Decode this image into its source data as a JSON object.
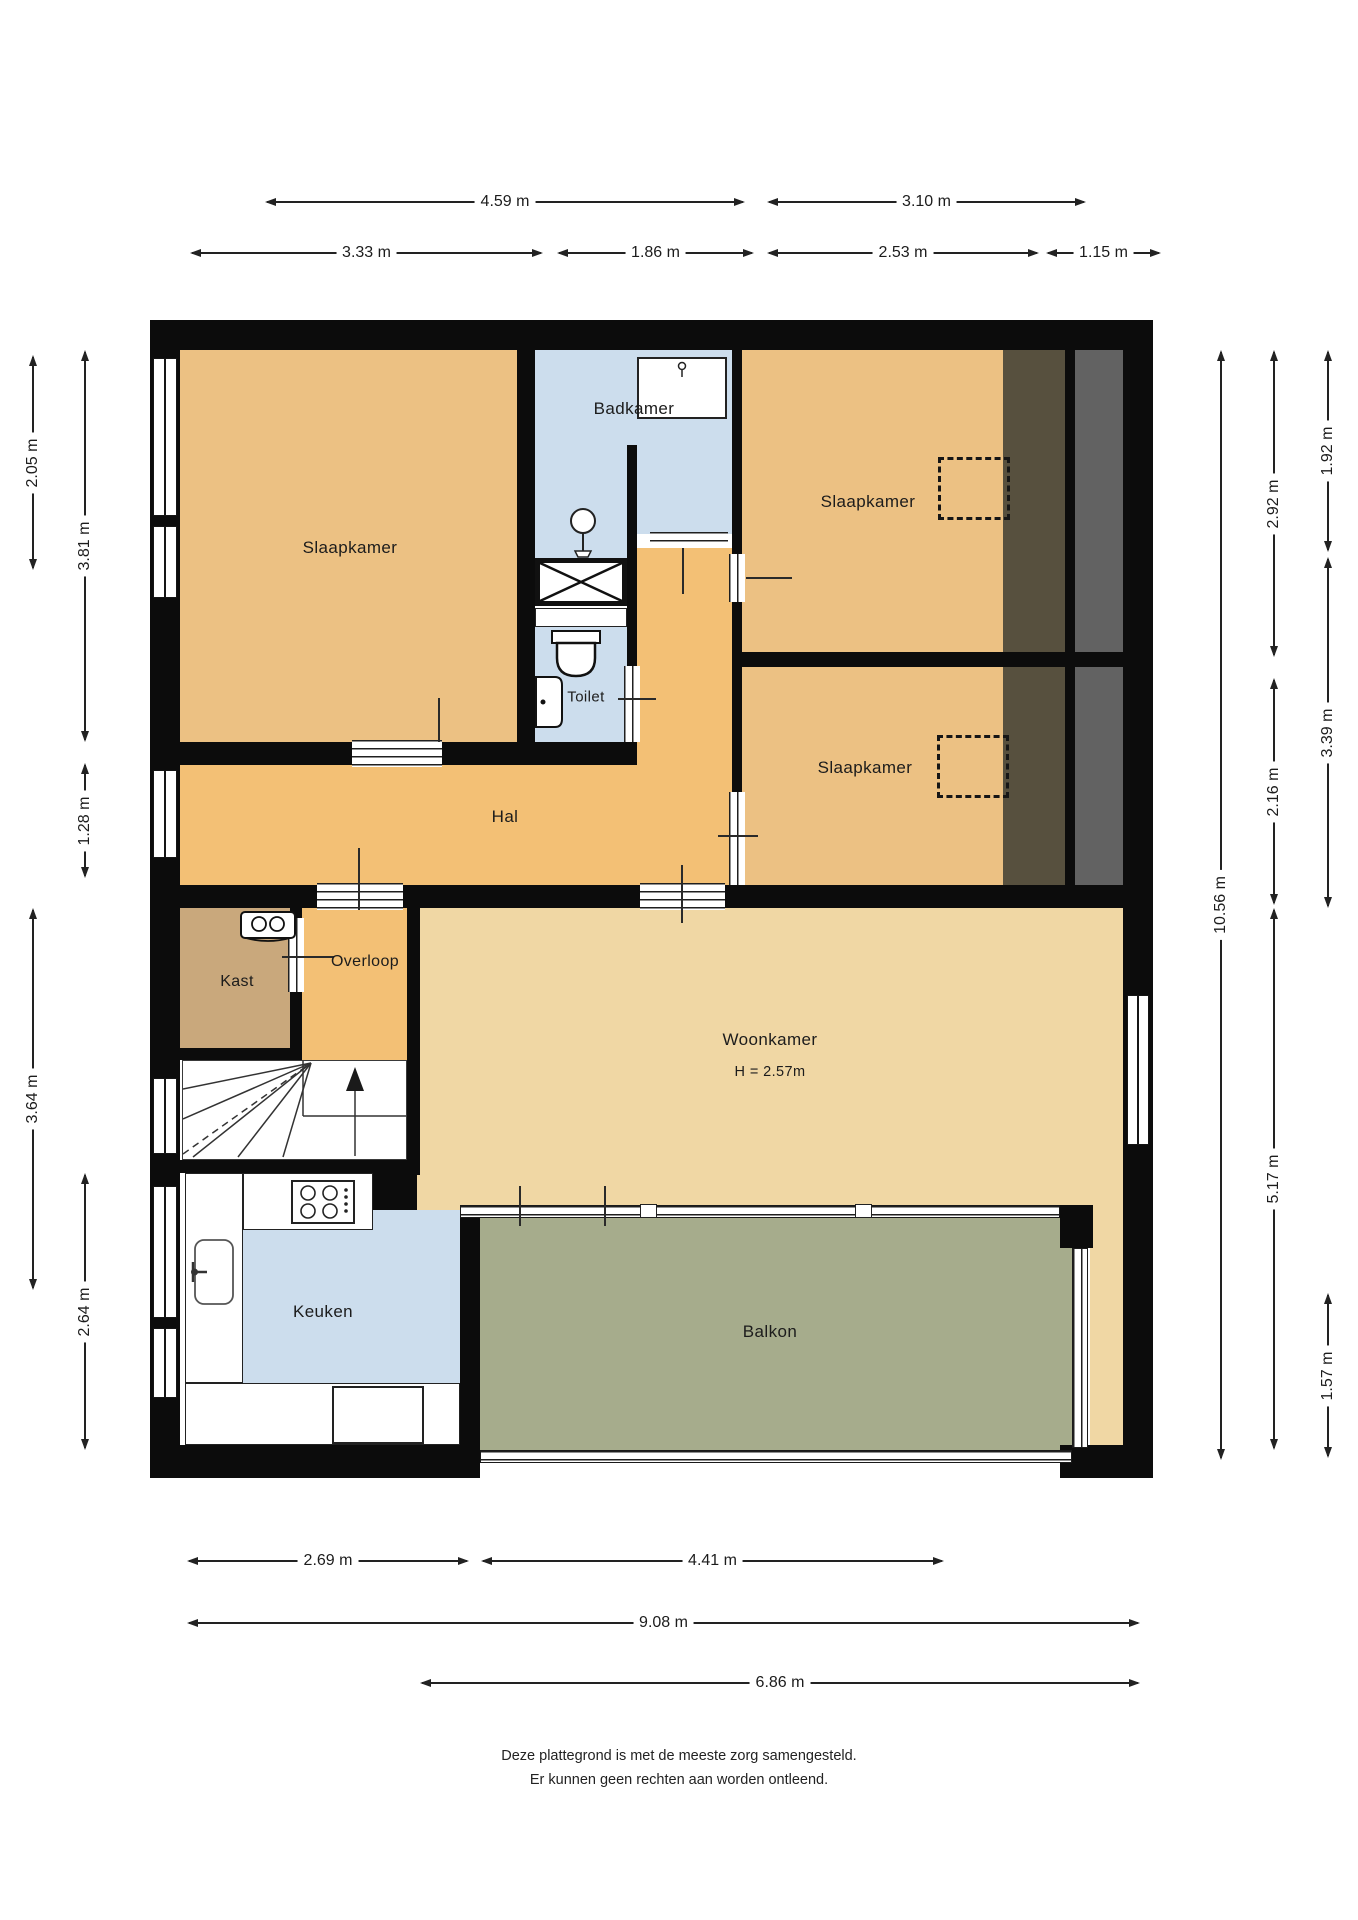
{
  "rooms": {
    "slaapkamer_tl": "Slaapkamer",
    "badkamer": "Badkamer",
    "slaapkamer_tr": "Slaapkamer",
    "slaapkamer_mr": "Slaapkamer",
    "toilet": "Toilet",
    "hal": "Hal",
    "kast": "Kast",
    "overloop": "Overloop",
    "woonkamer": "Woonkamer",
    "woonkamer_height": "H = 2.57m",
    "keuken": "Keuken",
    "balkon": "Balkon"
  },
  "dims": {
    "top1": [
      {
        "label": "4.59 m"
      },
      {
        "label": "3.10 m"
      }
    ],
    "top2": [
      {
        "label": "3.33 m"
      },
      {
        "label": "1.86 m"
      },
      {
        "label": "2.53 m"
      },
      {
        "label": "1.15 m"
      }
    ],
    "left": [
      {
        "label": "2.05 m"
      },
      {
        "label": "3.81 m"
      },
      {
        "label": "1.28 m"
      },
      {
        "label": "3.64 m"
      },
      {
        "label": "2.64 m"
      }
    ],
    "right": [
      {
        "label": "10.56 m"
      },
      {
        "label": "2.92 m"
      },
      {
        "label": "2.16 m"
      },
      {
        "label": "5.17 m"
      },
      {
        "label": "1.92 m"
      },
      {
        "label": "3.39 m"
      },
      {
        "label": "1.57 m"
      }
    ],
    "bottom": [
      {
        "label": "2.69 m"
      },
      {
        "label": "4.41 m"
      },
      {
        "label": "9.08 m"
      },
      {
        "label": "6.86 m"
      }
    ]
  },
  "footer": {
    "line1": "Deze plattegrond is met de meeste zorg samengesteld.",
    "line2": "Er kunnen geen rechten aan worden ontleend."
  },
  "colors": {
    "wall": "#0c0c0c",
    "bedroom": "#ecc183",
    "hall": "#f3c075",
    "living": "#f0d7a4",
    "closet": "#c9a87c",
    "wet_room": "#ccdded",
    "balcony": "#a6ac8c",
    "roof_dark": "#57503e",
    "roof_grey": "#626262"
  }
}
